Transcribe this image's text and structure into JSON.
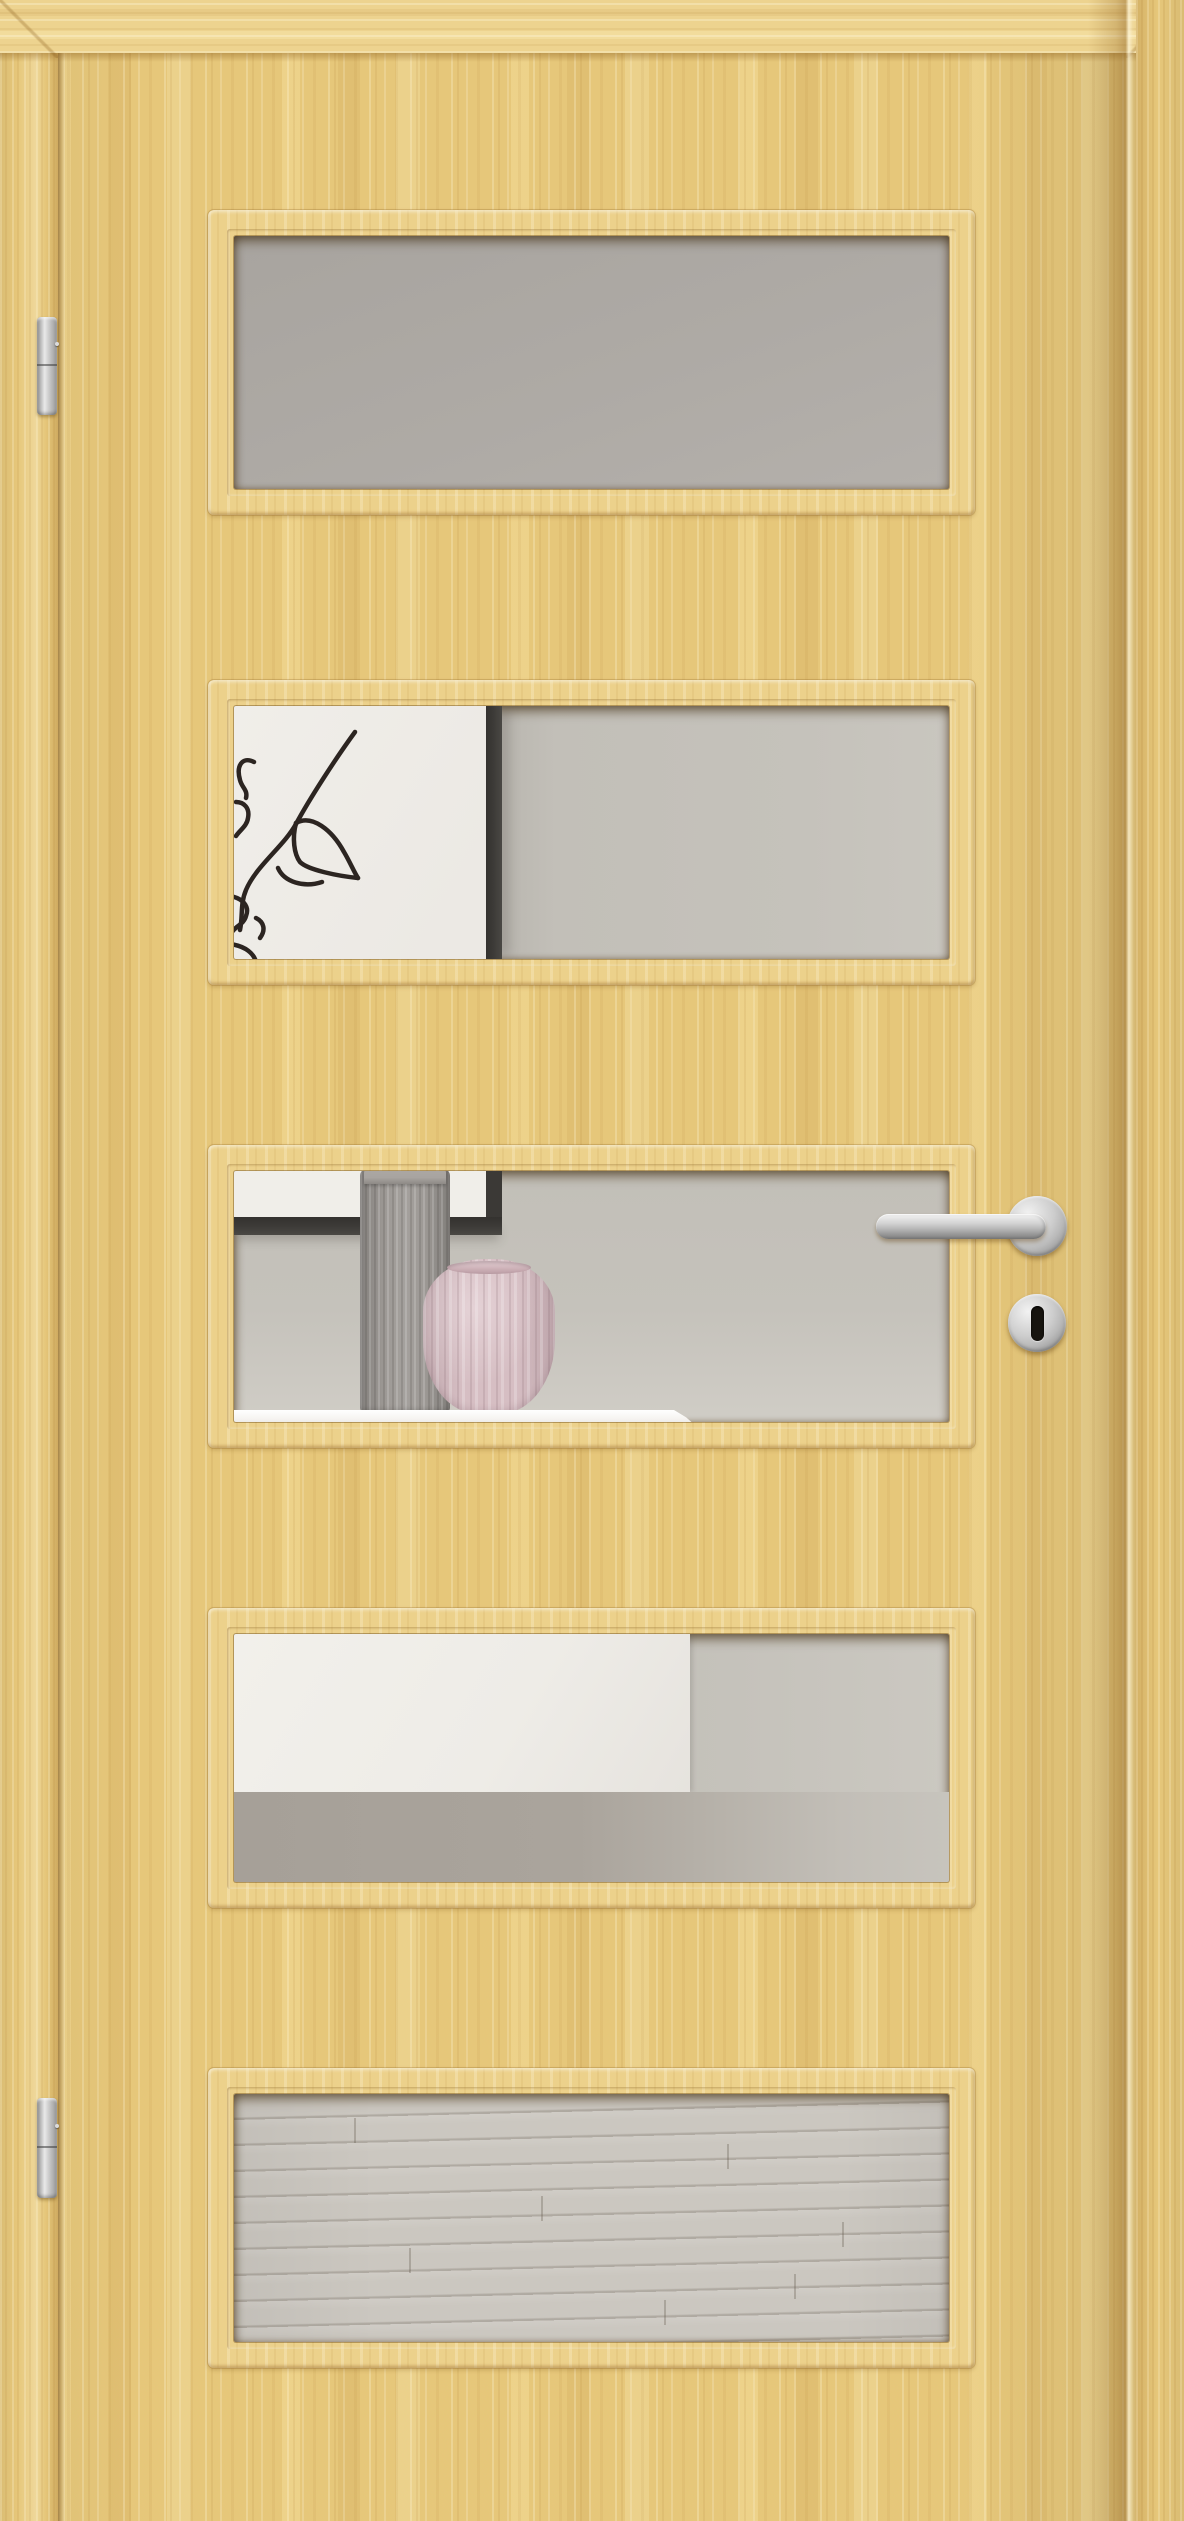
{
  "meta": {
    "image_type": "product-photo",
    "subject": "interior wooden door with five glazed lites",
    "material": "light maple veneer",
    "hinge_side": "left",
    "handle_side": "right"
  },
  "door": {
    "lite_count": 5,
    "lites": [
      {
        "id": 1,
        "scene": "frosted gray glass, plain wall behind"
      },
      {
        "id": 2,
        "scene": "black-framed abstract line-art picture on left, gray wall on right"
      },
      {
        "id": 3,
        "scene": "bottom corner of picture frame, gray ribbed vase and pink ribbed vase on white sideboard, lever handle overlapping right edge"
      },
      {
        "id": 4,
        "scene": "white sideboard block against gray wall"
      },
      {
        "id": 5,
        "scene": "light gray laminate floor planks"
      }
    ]
  },
  "hardware": {
    "lever_handle": {
      "type": "straight lever on round rose",
      "finish": "stainless steel"
    },
    "escutcheon": {
      "type": "round keyhole rose",
      "finish": "stainless steel",
      "keyhole": "black oval"
    },
    "hinges": {
      "count": 2,
      "type": "barrel hinge",
      "finish": "stainless steel"
    }
  },
  "colors": {
    "wood_face": "#e6c77a",
    "wood_band": "#edd38f",
    "wood_frame": "#ecd18b",
    "glass_gray": "#a8a49f",
    "glass_gray_light": "#b4b0ab",
    "wall_gray": "#c5c2bb",
    "paper_white": "#f0eee9",
    "line_art": "#2c2521",
    "frame_black": "#3b3936",
    "vase_gray": "#9d9995",
    "vase_gray_cap": "#a8a4a0",
    "vase_pink": "#d6bec3",
    "table_white": "#f6f4f1",
    "sideboard_white": "#eeece7",
    "under_strip": "#a6a098",
    "floor_light": "#cbc7c0",
    "metal_hi": "#e9e9e9",
    "metal_mid": "#b9b9b9",
    "metal_dark": "#7d7d7d",
    "keyhole_black": "#17140f"
  }
}
